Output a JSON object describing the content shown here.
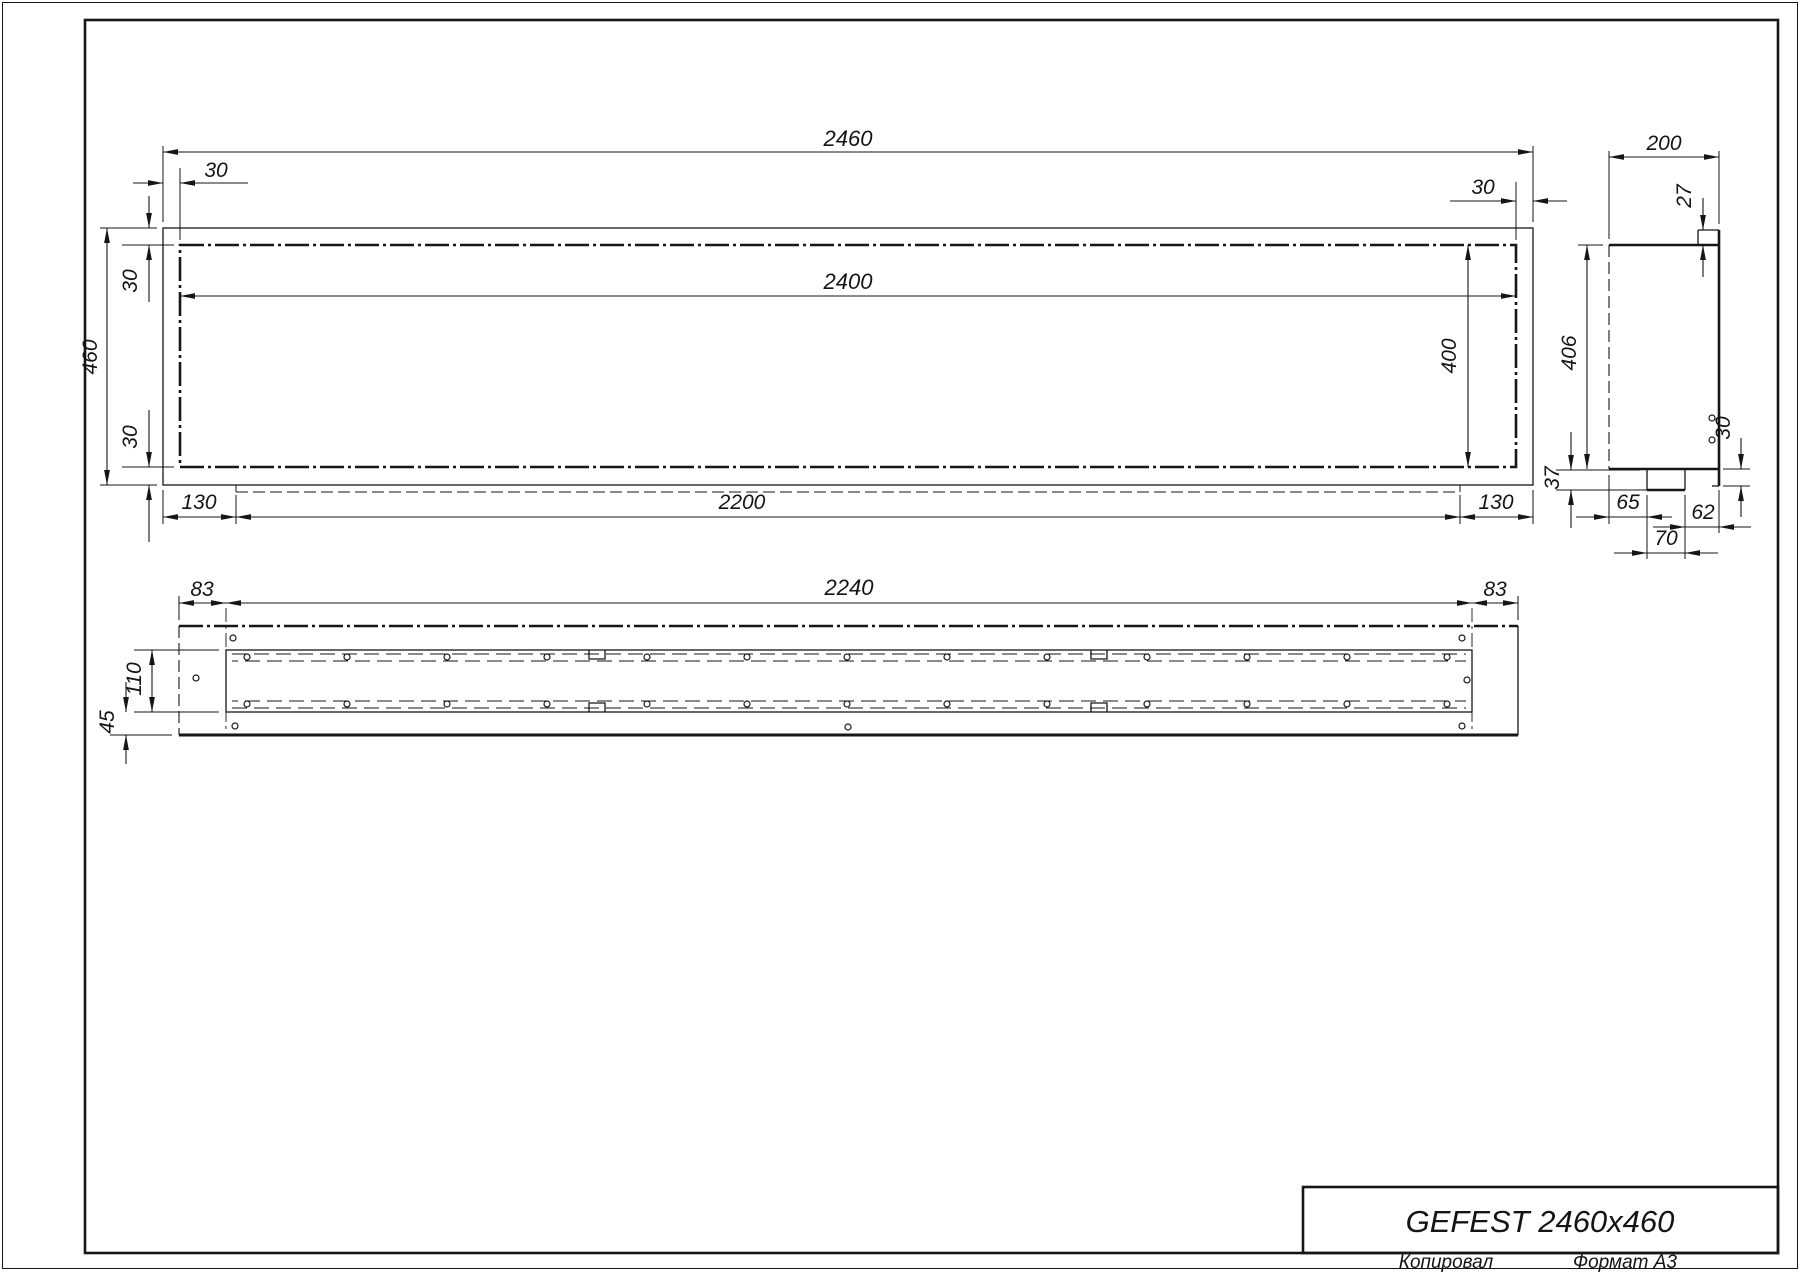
{
  "palette": {
    "ink": "#161616",
    "paper": "#ffffff"
  },
  "title_block": {
    "product_title": "GEFEST 2460x460"
  },
  "footer": {
    "copied_label": "Копировал",
    "format_label": "Формат А3"
  },
  "drawing": {
    "front_view": {
      "overall_width": "2460",
      "opening_width": "2400",
      "overall_height": "460",
      "frame_left_offset": "30",
      "frame_right_offset": "30",
      "inset_top": "30",
      "inset_bottom": "30",
      "opening_height": "400",
      "tray_left_offset": "130",
      "tray_length": "2200",
      "tray_right_offset": "130"
    },
    "side_view": {
      "depth": "200",
      "top_lip": "27",
      "body_height": "406",
      "tray_drop": "37",
      "bottom_lip": "30",
      "notch_back_offset": "65",
      "notch_width": "70",
      "notch_front_offset": "62"
    },
    "bottom_view": {
      "slot_left_margin": "83",
      "slot_length": "2240",
      "slot_right_margin": "83",
      "slot_width": "110",
      "edge_offset": "45"
    }
  }
}
